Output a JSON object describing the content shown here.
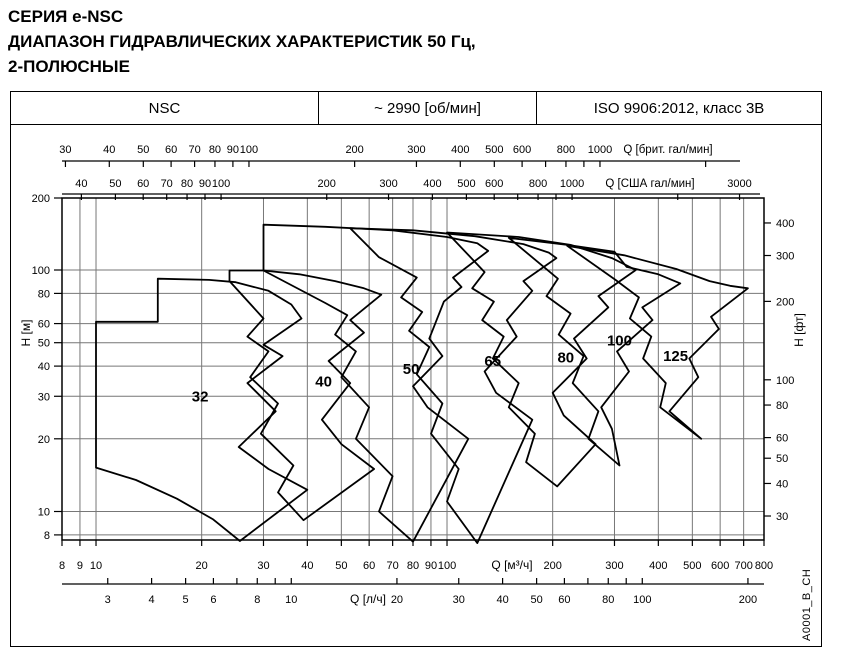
{
  "title": {
    "line1": "СЕРИЯ e-NSC",
    "line2": "ДИАПАЗОН ГИДРАВЛИЧЕСКИХ ХАРАКТЕРИСТИК 50 Гц,",
    "line3": "2-ПОЛЮСНЫЕ"
  },
  "header": {
    "series": "NSC",
    "speed": "~ 2990 [об/мин]",
    "standard": "ISO 9906:2012, класс 3В"
  },
  "side_label": "A0001_B_CH",
  "chart_data": {
    "type": "area",
    "description": "Hydraulic range envelopes of e-NSC pump sizes, 50 Hz, 2-pole, log-log axes",
    "grid": {
      "x": [
        9,
        10,
        20,
        30,
        40,
        50,
        60,
        70,
        80,
        90,
        100,
        200,
        300,
        400,
        500,
        600,
        700
      ],
      "y": [
        8,
        10,
        20,
        30,
        40,
        50,
        60,
        80,
        100
      ]
    },
    "axes": {
      "x_main": {
        "label": "Q [м³/ч]",
        "range": [
          8,
          800
        ],
        "ticks": [
          8,
          9,
          10,
          20,
          30,
          40,
          50,
          60,
          70,
          80,
          90,
          100,
          200,
          300,
          400,
          500,
          600,
          700,
          800
        ]
      },
      "x_brit": {
        "label": "Q [брит. гал/мин]",
        "factor": 3.6664,
        "ticks": [
          30,
          40,
          50,
          60,
          70,
          80,
          90,
          100,
          200,
          300,
          400,
          500,
          600,
          800,
          1000
        ],
        "minor": [
          700,
          900,
          2000
        ]
      },
      "x_usa": {
        "label": "Q [США гал/мин]",
        "factor": 4.4029,
        "ticks": [
          40,
          50,
          60,
          70,
          80,
          90,
          100,
          200,
          300,
          400,
          500,
          600,
          800,
          1000,
          3000
        ],
        "minor": [
          700,
          900,
          2000
        ]
      },
      "x_ls": {
        "label": "Q [л/ч]",
        "factor": 0.27778,
        "ticks": [
          3,
          4,
          5,
          6,
          8,
          10,
          20,
          30,
          40,
          50,
          60,
          80,
          100,
          200
        ],
        "minor": [
          7,
          9,
          70,
          90
        ]
      },
      "y_left": {
        "label": "H [м]",
        "range": [
          7.5,
          200
        ],
        "ticks": [
          200,
          100,
          80,
          60,
          50,
          40,
          30,
          20,
          10,
          8
        ]
      },
      "y_right": {
        "label": "H [фт]",
        "ticks": [
          400,
          300,
          200,
          100,
          80,
          60,
          50,
          40,
          30
        ]
      }
    },
    "series": [
      {
        "name": "32",
        "label_pos": [
          19.8,
          30
        ],
        "points": [
          [
            10,
            61
          ],
          [
            15,
            61
          ],
          [
            15,
            92
          ],
          [
            21,
            91
          ],
          [
            25,
            89
          ],
          [
            31,
            82
          ],
          [
            36,
            72
          ],
          [
            38.5,
            63
          ],
          [
            30,
            49
          ],
          [
            34,
            44
          ],
          [
            27,
            34
          ],
          [
            32.5,
            26
          ],
          [
            25.5,
            18.5
          ],
          [
            31,
            15
          ],
          [
            40,
            12.3
          ],
          [
            25.7,
            7.55
          ],
          [
            21.5,
            9.3
          ],
          [
            17,
            11.3
          ],
          [
            13,
            13.5
          ],
          [
            10,
            15.2
          ]
        ]
      },
      {
        "name": "40",
        "label_pos": [
          44.5,
          34.5
        ],
        "points": [
          [
            24,
            90
          ],
          [
            24,
            99.5
          ],
          [
            30,
            99.5
          ],
          [
            38,
            96
          ],
          [
            48,
            90
          ],
          [
            58,
            84
          ],
          [
            65,
            79
          ],
          [
            53,
            62
          ],
          [
            58,
            55
          ],
          [
            46,
            42
          ],
          [
            53,
            34
          ],
          [
            44,
            24
          ],
          [
            50,
            19
          ],
          [
            62,
            15
          ],
          [
            39,
            9.2
          ],
          [
            33,
            12
          ],
          [
            36.5,
            15.5
          ],
          [
            29.5,
            21
          ],
          [
            33,
            28
          ],
          [
            27.5,
            36
          ],
          [
            31,
            46
          ],
          [
            27,
            53
          ],
          [
            30,
            63
          ]
        ]
      },
      {
        "name": "50",
        "label_pos": [
          79,
          39
        ],
        "points": [
          [
            30,
            99.5
          ],
          [
            30,
            154
          ],
          [
            45,
            151
          ],
          [
            70,
            146
          ],
          [
            100,
            137
          ],
          [
            122,
            129
          ],
          [
            131,
            120
          ],
          [
            104,
            93
          ],
          [
            110,
            85
          ],
          [
            98,
            74
          ],
          [
            89,
            52
          ],
          [
            97,
            44
          ],
          [
            80,
            33
          ],
          [
            88,
            27
          ],
          [
            115,
            20
          ],
          [
            80,
            7.5
          ],
          [
            64,
            10
          ],
          [
            70,
            14
          ],
          [
            55,
            20
          ],
          [
            60,
            27
          ],
          [
            50,
            36
          ],
          [
            55,
            46
          ],
          [
            48,
            54
          ],
          [
            52,
            65
          ],
          [
            45,
            73
          ]
        ]
      },
      {
        "name": "65",
        "label_pos": [
          135,
          42
        ],
        "points": [
          [
            53,
            149
          ],
          [
            80,
            146
          ],
          [
            120,
            138
          ],
          [
            165,
            128
          ],
          [
            195,
            118
          ],
          [
            205,
            112
          ],
          [
            165,
            90
          ],
          [
            175,
            82
          ],
          [
            148,
            62
          ],
          [
            158,
            53
          ],
          [
            128,
            38
          ],
          [
            138,
            31
          ],
          [
            175,
            24
          ],
          [
            122,
            7.4
          ],
          [
            100,
            11
          ],
          [
            108,
            15
          ],
          [
            90,
            21
          ],
          [
            97,
            28
          ],
          [
            82,
            37
          ],
          [
            89,
            48
          ],
          [
            78,
            56
          ],
          [
            85,
            67
          ],
          [
            74,
            77
          ],
          [
            82,
            93
          ],
          [
            64,
            113
          ]
        ]
      },
      {
        "name": "80",
        "label_pos": [
          218,
          43.5
        ],
        "points": [
          [
            100,
            143
          ],
          [
            160,
            137
          ],
          [
            225,
            127
          ],
          [
            295,
            112
          ],
          [
            345,
            100
          ],
          [
            270,
            78
          ],
          [
            288,
            70
          ],
          [
            230,
            52
          ],
          [
            250,
            43
          ],
          [
            200,
            31
          ],
          [
            215,
            25
          ],
          [
            265,
            19
          ],
          [
            206,
            12.7
          ],
          [
            168,
            16
          ],
          [
            178,
            21
          ],
          [
            150,
            27
          ],
          [
            160,
            34
          ],
          [
            135,
            43
          ],
          [
            145,
            53
          ],
          [
            126,
            62
          ],
          [
            136,
            74
          ],
          [
            118,
            84
          ],
          [
            128,
            98
          ]
        ]
      },
      {
        "name": "100",
        "label_pos": [
          310,
          51
        ],
        "points": [
          [
            150,
            136
          ],
          [
            220,
            127
          ],
          [
            300,
            119
          ],
          [
            325,
            103
          ],
          [
            400,
            96
          ],
          [
            462,
            88
          ],
          [
            360,
            70
          ],
          [
            385,
            62
          ],
          [
            305,
            46
          ],
          [
            330,
            38
          ],
          [
            275,
            27
          ],
          [
            295,
            22
          ],
          [
            310,
            15.5
          ],
          [
            253,
            20
          ],
          [
            270,
            26
          ],
          [
            228,
            34
          ],
          [
            245,
            44
          ],
          [
            208,
            54
          ],
          [
            225,
            66
          ],
          [
            192,
            78
          ],
          [
            207,
            92
          ]
        ]
      },
      {
        "name": "125",
        "label_pos": [
          448,
          44
        ],
        "points": [
          [
            220,
            126
          ],
          [
            320,
            115
          ],
          [
            450,
            101
          ],
          [
            560,
            90
          ],
          [
            640,
            86
          ],
          [
            720,
            84
          ],
          [
            565,
            64
          ],
          [
            595,
            57
          ],
          [
            490,
            43
          ],
          [
            520,
            36
          ],
          [
            430,
            26
          ],
          [
            530,
            20
          ],
          [
            405,
            27
          ],
          [
            420,
            34
          ],
          [
            362,
            43
          ],
          [
            382,
            53
          ],
          [
            332,
            63
          ],
          [
            352,
            77
          ],
          [
            302,
            91
          ]
        ]
      }
    ]
  }
}
